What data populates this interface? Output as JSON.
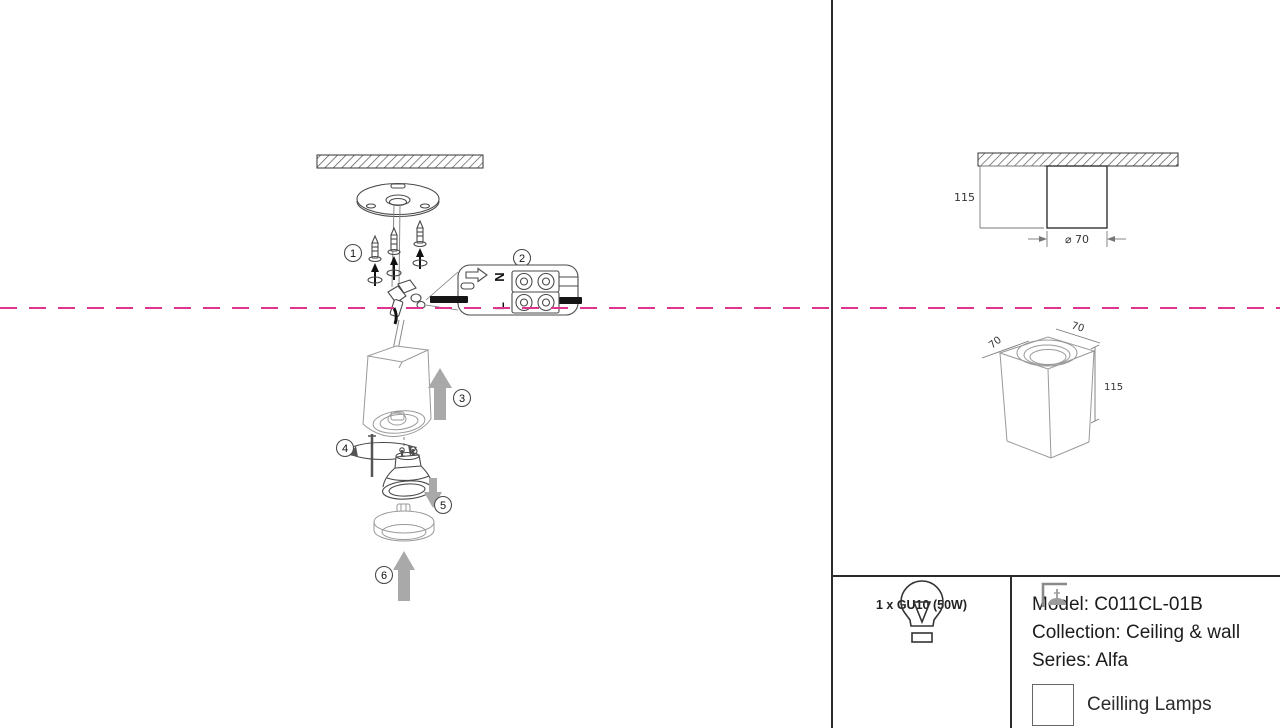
{
  "colors": {
    "accent": "#e0358f",
    "line_dark": "#2b2b2b",
    "arrow_gray": "#a9a9a9"
  },
  "steps": {
    "s1": "1",
    "s2": "2",
    "s3": "3",
    "s4": "4",
    "s5": "5",
    "s6": "6"
  },
  "wiring": {
    "neutral": "N",
    "live": "L"
  },
  "side_view": {
    "height": "115",
    "diameter": "⌀ 70"
  },
  "iso_view": {
    "width": "70",
    "depth": "70",
    "height": "115"
  },
  "spec": {
    "bulb": "1 x GU10 (50W)"
  },
  "product": {
    "model": "Model: C011CL-01B",
    "collection": "Collection: Ceiling & wall",
    "series": "Series: Alfa",
    "category": "Ceilling Lamps"
  }
}
